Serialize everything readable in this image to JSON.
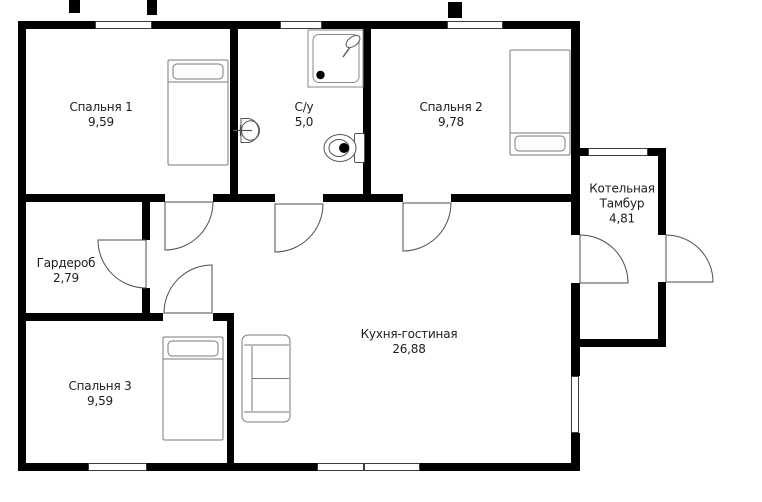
{
  "plan": {
    "type": "floor-plan",
    "rooms": [
      {
        "id": "bedroom-1",
        "name": "Спальня 1",
        "area": "9,59"
      },
      {
        "id": "bathroom",
        "name": "С/у",
        "area": "5,0"
      },
      {
        "id": "bedroom-2",
        "name": "Спальня 2",
        "area": "9,78"
      },
      {
        "id": "boiler-vestibule",
        "name": "Котельная",
        "name2": "Тамбур",
        "area": "4,81"
      },
      {
        "id": "wardrobe",
        "name": "Гардероб",
        "area": "2,79"
      },
      {
        "id": "bedroom-3",
        "name": "Спальня 3",
        "area": "9,59"
      },
      {
        "id": "kitchen-living",
        "name": "Кухня-гостиная",
        "area": "26,88"
      }
    ],
    "colors": {
      "wall": "#000000",
      "door_line": "#4d4d4d",
      "furniture_line": "#7a7a7a",
      "text": "#1d1d1d",
      "background": "#ffffff"
    }
  }
}
